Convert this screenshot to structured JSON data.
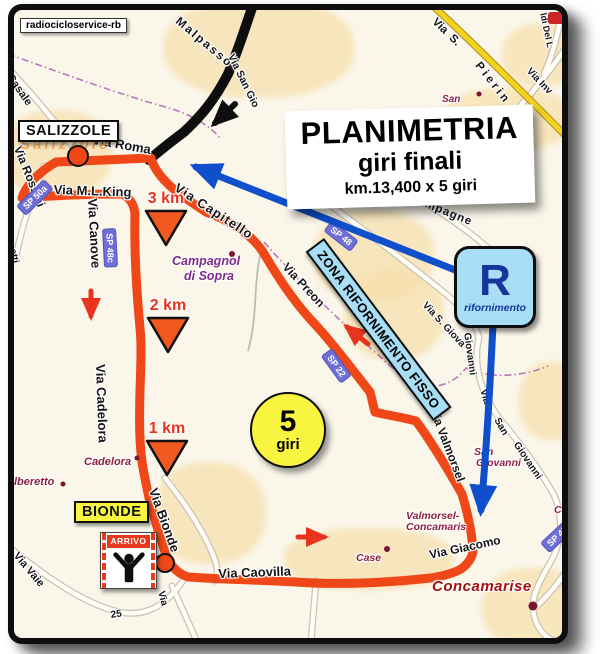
{
  "watermark": "radiocicloservice-rb",
  "title_box": {
    "title": "PLANIMETRIA",
    "subtitle": "giri finali",
    "distance": "km.13,400 x 5 giri"
  },
  "lap_badge": {
    "number": "5",
    "unit": "giri"
  },
  "feed_zone": {
    "banner": "ZONA RIFORNIMENTO FISSO",
    "symbol": "R",
    "caption": "rifornimento"
  },
  "town_labels": {
    "salizzole": "SALIZZOLE",
    "bionde": "BIONDE"
  },
  "finish_flag": {
    "label": "ARRIVO"
  },
  "km_markers": [
    {
      "label": "3 km",
      "x": 120,
      "y": 180
    },
    {
      "label": "2 km",
      "x": 122,
      "y": 287
    },
    {
      "label": "1 km",
      "x": 121,
      "y": 410
    }
  ],
  "map_labels": [
    {
      "t": "Malpasso",
      "x": 168,
      "y": 4,
      "r": 40,
      "s": 12,
      "ls": 2,
      "cls": "street"
    },
    {
      "t": "Via San Gio",
      "x": 222,
      "y": 42,
      "r": 64,
      "s": 10.5,
      "cls": "street"
    },
    {
      "t": "Casale",
      "x": 0,
      "y": 62,
      "r": 55,
      "s": 11,
      "cls": "street"
    },
    {
      "t": "Via  S.",
      "x": 424,
      "y": 6,
      "r": 44,
      "s": 11.5,
      "cls": "street"
    },
    {
      "t": "Pierin",
      "x": 468,
      "y": 50,
      "r": 52,
      "s": 11.5,
      "ls": 3,
      "cls": "street"
    },
    {
      "t": "Via Inv",
      "x": 518,
      "y": 56,
      "r": 46,
      "s": 10,
      "cls": "street"
    },
    {
      "t": "ldi Del L",
      "x": 534,
      "y": 2,
      "r": 78,
      "s": 9,
      "cls": "street"
    },
    {
      "t": "Campagne",
      "x": 398,
      "y": 182,
      "r": 22,
      "s": 11.5,
      "ls": 1,
      "cls": "street"
    },
    {
      "t": "Via Roma",
      "x": 80,
      "y": 122,
      "r": 10,
      "s": 13,
      "cls": "street"
    },
    {
      "t": "Via M.L.King",
      "x": 40,
      "y": 172,
      "r": 2,
      "s": 13,
      "cls": "street"
    },
    {
      "t": "Via Rossini",
      "x": 10,
      "y": 134,
      "r": 68,
      "s": 12,
      "cls": "street"
    },
    {
      "t": "Via Canove",
      "x": 86,
      "y": 188,
      "r": 87,
      "s": 13,
      "cls": "street"
    },
    {
      "t": "Via Capitello",
      "x": 166,
      "y": 170,
      "r": 33,
      "s": 13,
      "ls": 1,
      "cls": "street"
    },
    {
      "t": "Via Preon",
      "x": 276,
      "y": 250,
      "r": 47,
      "s": 12,
      "cls": "street"
    },
    {
      "t": "Via Cadelora",
      "x": 94,
      "y": 354,
      "r": 88,
      "s": 13,
      "cls": "street"
    },
    {
      "t": "Via Bionde",
      "x": 146,
      "y": 476,
      "r": 70,
      "s": 13,
      "cls": "street"
    },
    {
      "t": "Via Caovilla",
      "x": 204,
      "y": 556,
      "r": -2,
      "s": 13,
      "cls": "street"
    },
    {
      "t": "Via Giacomo",
      "x": 414,
      "y": 538,
      "r": -12,
      "s": 12,
      "cls": "street"
    },
    {
      "t": "Via Valmorsel",
      "x": 426,
      "y": 396,
      "r": 69,
      "s": 12,
      "cls": "street"
    },
    {
      "t": "Via S. Giova",
      "x": 414,
      "y": 290,
      "r": 47,
      "s": 10,
      "cls": "street"
    },
    {
      "t": "Giovanni",
      "x": 458,
      "y": 322,
      "r": 82,
      "s": 10,
      "cls": "street"
    },
    {
      "t": "Via",
      "x": 474,
      "y": 378,
      "r": 74,
      "s": 10,
      "cls": "street"
    },
    {
      "t": "San",
      "x": 487,
      "y": 406,
      "r": 60,
      "s": 10,
      "cls": "street"
    },
    {
      "t": "Giovanni",
      "x": 506,
      "y": 430,
      "r": 56,
      "s": 10,
      "cls": "street"
    },
    {
      "t": "Via Vaie",
      "x": 6,
      "y": 540,
      "r": 50,
      "s": 11,
      "cls": "street"
    },
    {
      "t": "Via",
      "x": 152,
      "y": 580,
      "r": 76,
      "s": 10,
      "cls": "street"
    },
    {
      "t": "25",
      "x": 96,
      "y": 600,
      "r": -8,
      "s": 10,
      "cls": "street"
    },
    {
      "t": "Aprile",
      "x": 112,
      "y": 572,
      "r": -36,
      "s": 11,
      "cls": "street"
    },
    {
      "t": "etti",
      "x": 4,
      "y": 238,
      "r": 78,
      "s": 9.5,
      "cls": "street"
    },
    {
      "t": "San",
      "x": 428,
      "y": 84,
      "s": 10,
      "cls": "place"
    },
    {
      "t": "Campagnol",
      "x": 158,
      "y": 244,
      "s": 12.5,
      "cls": "place2"
    },
    {
      "t": "di Sopra",
      "x": 170,
      "y": 259,
      "s": 12.5,
      "cls": "place2"
    },
    {
      "t": "Cadelora",
      "x": 70,
      "y": 446,
      "s": 11,
      "cls": "place"
    },
    {
      "t": "lberetto",
      "x": 0,
      "y": 466,
      "s": 11,
      "cls": "place"
    },
    {
      "t": "San",
      "x": 460,
      "y": 436,
      "s": 10.5,
      "cls": "place"
    },
    {
      "t": "Giovanni",
      "x": 462,
      "y": 447,
      "s": 10.5,
      "cls": "place"
    },
    {
      "t": "Valmorsel-",
      "x": 392,
      "y": 500,
      "s": 10.5,
      "cls": "place"
    },
    {
      "t": "Concamaris",
      "x": 392,
      "y": 511,
      "s": 10.5,
      "cls": "place"
    },
    {
      "t": "Case",
      "x": 342,
      "y": 542,
      "s": 10.5,
      "cls": "place"
    },
    {
      "t": "Cap",
      "x": 540,
      "y": 494,
      "s": 10.5,
      "cls": "place"
    },
    {
      "t": "Fo",
      "x": 550,
      "y": 418,
      "s": 10.5,
      "cls": "place"
    },
    {
      "t": "Concamarise",
      "x": 418,
      "y": 568,
      "s": 15,
      "cls": "place-big"
    },
    {
      "t": "Salizzole",
      "x": 6,
      "y": 126,
      "s": 15,
      "ls": 3,
      "cls": "town-faint"
    }
  ],
  "road_shields": [
    {
      "t": "SP 48",
      "x": 318,
      "y": 210,
      "r": 38
    },
    {
      "t": "SP 22",
      "x": 318,
      "y": 338,
      "r": 54
    },
    {
      "t": "SP 48c",
      "x": 102,
      "y": 218,
      "r": 87
    },
    {
      "t": "SP 50a",
      "x": 2,
      "y": 196,
      "r": -44
    },
    {
      "t": "SP 48",
      "x": 526,
      "y": 533,
      "r": -43
    }
  ],
  "colors": {
    "route": "#f04718",
    "arrowRed": "#e8331f",
    "arrowBlue": "#0f4fcb",
    "feedBlue": "#a8def5",
    "lapYellow": "#f8f440",
    "markerOrange": "#f2591f",
    "shieldBlue": "#6f6fd8"
  }
}
